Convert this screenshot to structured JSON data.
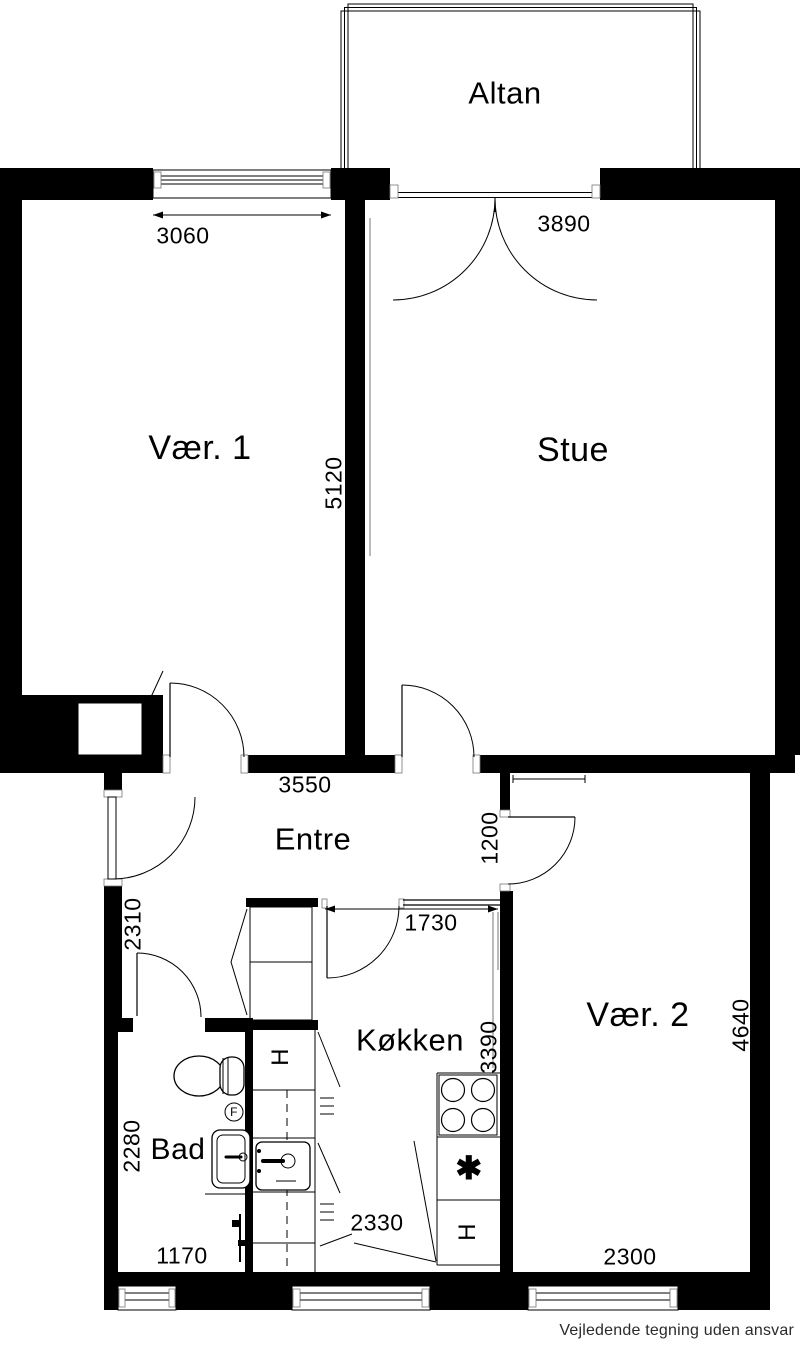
{
  "rooms": {
    "altan": "Altan",
    "vaer1": "Vær. 1",
    "stue": "Stue",
    "entre": "Entre",
    "vaer2": "Vær. 2",
    "koekken": "Køkken",
    "bad": "Bad"
  },
  "dimensions_mm": {
    "vaer1_window": "3060",
    "stue_balcony_door": "3890",
    "vaer1_depth": "5120",
    "entre_width": "3550",
    "vaer2_wall_segment": "1200",
    "entre_depth": "2310",
    "koekken_top": "1730",
    "koekken_depth": "3390",
    "vaer2_depth": "4640",
    "bad_depth": "2280",
    "bad_width": "1170",
    "koekken_width": "2330",
    "vaer2_window": "2300"
  },
  "symbols": {
    "cabinet_upper": "H",
    "cabinet_lower": "H",
    "freezer_star": "✱",
    "floor_drain": "F"
  },
  "colors": {
    "wall": "#000000",
    "background": "#ffffff",
    "line": "#000000"
  },
  "footer": {
    "disclaimer": "Vejledende tegning uden ansvar"
  }
}
